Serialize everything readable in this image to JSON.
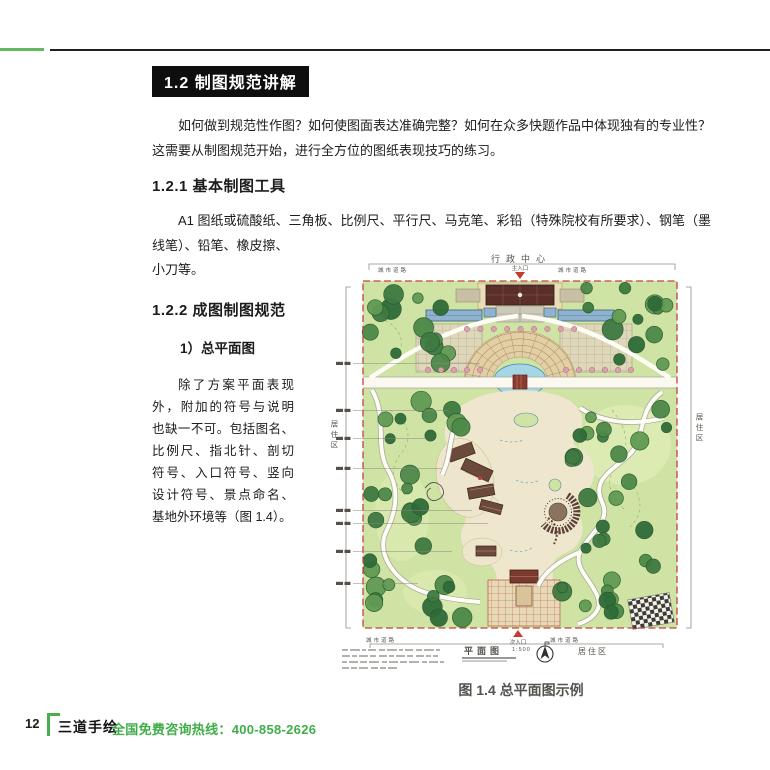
{
  "colors": {
    "accent_green": "#47ad4f",
    "heading_bg": "#0e0e0e",
    "entrance_red": "#c63b2e",
    "plan_border_red": "#c0443a"
  },
  "heading": {
    "title": "1.2 制图规范讲解"
  },
  "intro": {
    "lines": [
      "如何做到规范性作图？如何使图面表达准确完整？如何在众多快题作品中体现独有的专业性？",
      "这需要从制图规范开始，进行全方位的图纸表现技巧的练习。"
    ]
  },
  "sub1": {
    "title": "1.2.1 基本制图工具",
    "lines": [
      "A1 图纸或硫酸纸、三角板、比例尺、平行尺、马克笔、彩铅（特殊院校有所要求）、钢笔（墨",
      "线笔）、铅笔、橡皮擦、",
      "小刀等。"
    ]
  },
  "sub2": {
    "title": "1.2.2 成图制图规范",
    "item": "1）总平面图",
    "lines": [
      "除了方案平面表现",
      "外，附加的符号与说明",
      "也缺一不可。包括图名、",
      "比例尺、指北针、剖切",
      "符号、入口符号、竖向",
      "设计符号、景点命名、",
      "基地外环境等（图 1.4）。"
    ]
  },
  "figure": {
    "caption": "图 1.4 总平面图示例",
    "labels": {
      "top_zone": "行政中心",
      "main_entrance": "主入口",
      "secondary_entrance": "次入口",
      "road": "城市道路",
      "residential": "居住区",
      "plan_title": "平面图",
      "plan_scale": "1:500"
    }
  },
  "footer": {
    "page_number": "12",
    "brand": "三道手绘",
    "hotline": "全国免费咨询热线：400-858-2626"
  }
}
